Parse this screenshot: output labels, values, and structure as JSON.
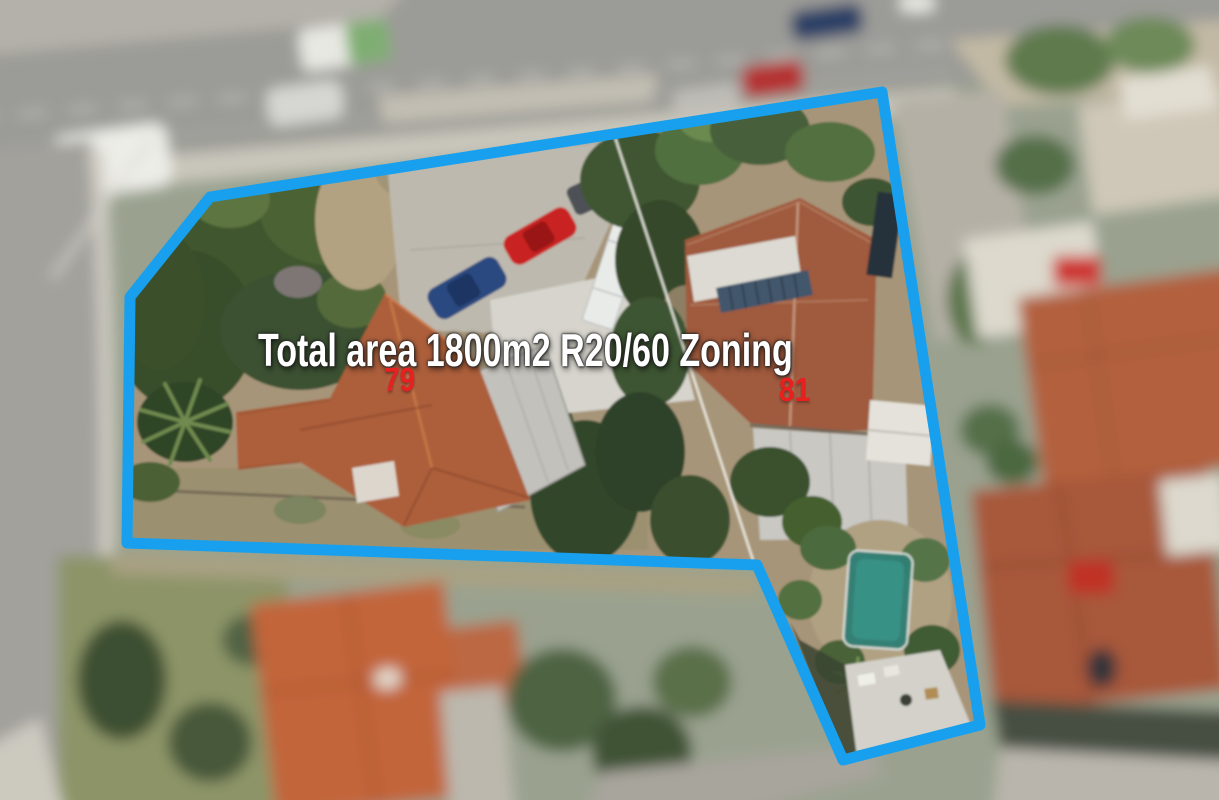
{
  "overlay": {
    "total_area_label": "Total area 1800m2 R20/60 Zoning",
    "lot_79": "79",
    "lot_81": "81"
  },
  "colors": {
    "boundary_blue": "#18a0ee",
    "lot_number_red": "#e8211f",
    "label_white": "#ffffff"
  }
}
